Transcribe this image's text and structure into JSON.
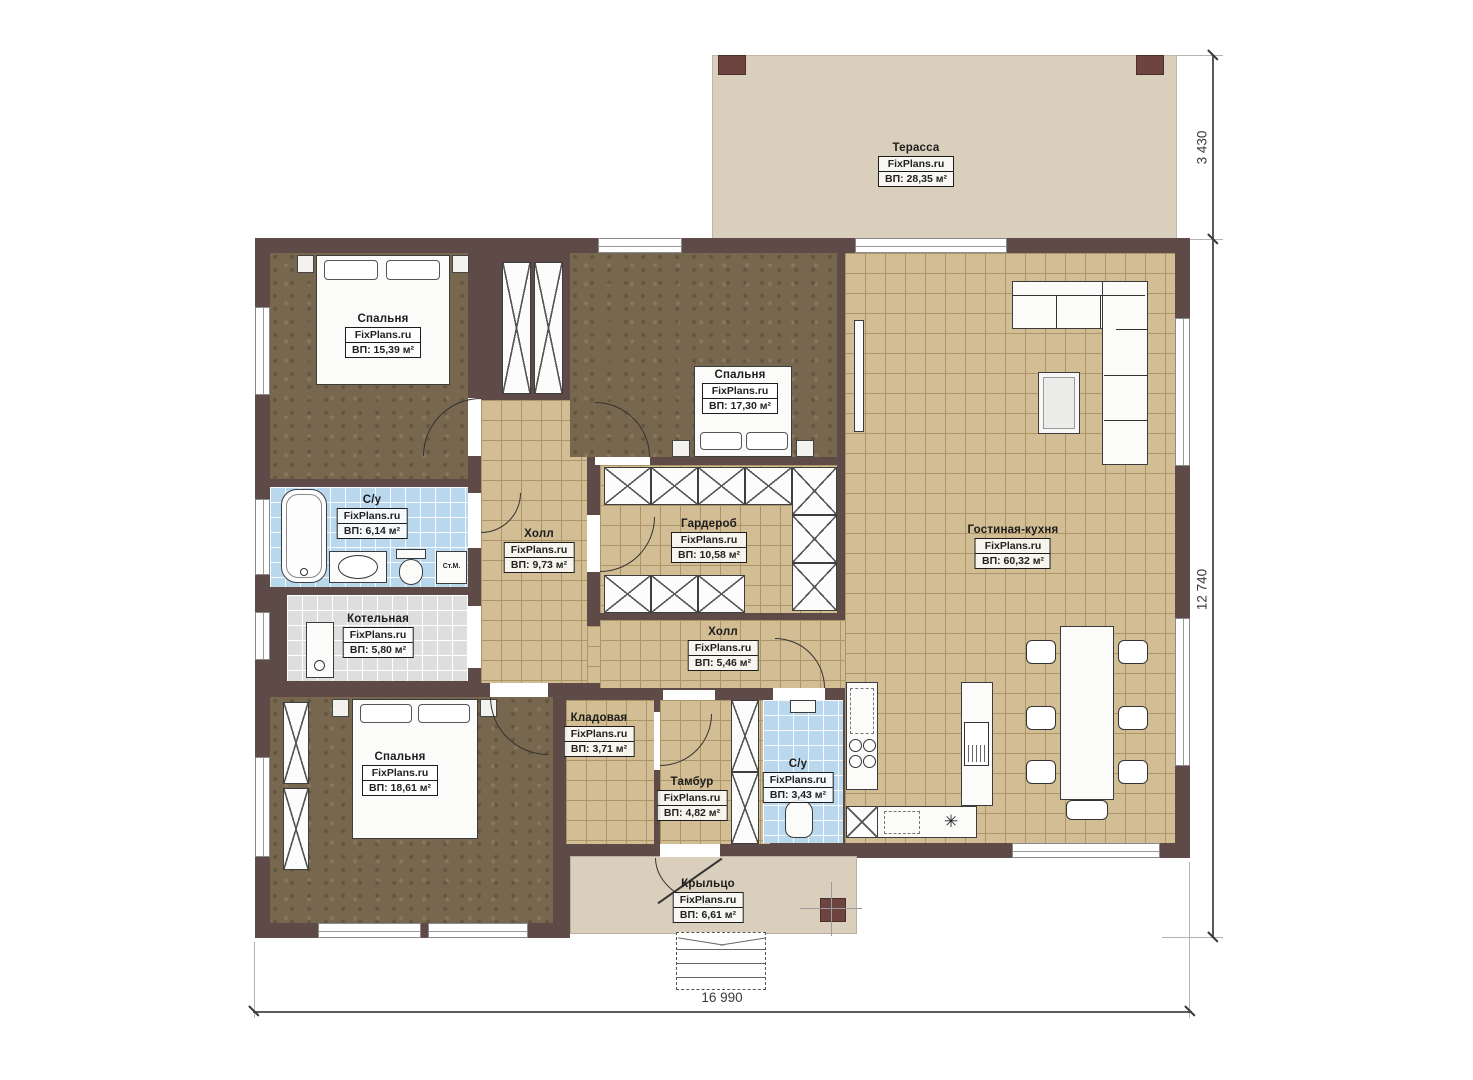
{
  "watermark": "FixPlans.ru",
  "rooms": {
    "terrace": {
      "name": "Терасса",
      "area": "ВП: 28,35 м²"
    },
    "bedroom1": {
      "name": "Спальня",
      "area": "ВП: 15,39 м²"
    },
    "bedroom2": {
      "name": "Спальня",
      "area": "ВП: 17,30 м²"
    },
    "bathroom1": {
      "name": "С/у",
      "area": "ВП: 6,14 м²"
    },
    "hall1": {
      "name": "Холл",
      "area": "ВП: 9,73 м²"
    },
    "wardrobe": {
      "name": "Гардероб",
      "area": "ВП: 10,58 м²"
    },
    "living_kitchen": {
      "name": "Гостиная-кухня",
      "area": "ВП: 60,32 м²"
    },
    "boiler": {
      "name": "Котельная",
      "area": "ВП: 5,80 м²"
    },
    "hall2": {
      "name": "Холл",
      "area": "ВП: 5,46 м²"
    },
    "pantry": {
      "name": "Кладовая",
      "area": "ВП: 3,71 м²"
    },
    "bedroom3": {
      "name": "Спальня",
      "area": "ВП: 18,61 м²"
    },
    "vestibule": {
      "name": "Тамбур",
      "area": "ВП: 4,82 м²"
    },
    "bathroom2": {
      "name": "С/у",
      "area": "ВП: 3,43 м²"
    },
    "porch": {
      "name": "Крыльцо",
      "area": "ВП: 6,61 м²"
    }
  },
  "annotations": {
    "washing_machine": "Ст.М.",
    "sink_symbol": "✳"
  },
  "dimensions": {
    "terrace_depth": "3 430",
    "house_depth": "12 740",
    "house_width": "16 990"
  },
  "colors": {
    "wall": "#5e4b48",
    "tile": "#d2bd94",
    "tile_line": "#ab9668",
    "carpet": "#77674f",
    "blue_tile": "#b9d8ee",
    "gray_tile": "#dedede",
    "terrace": "#d9cfbc",
    "post": "#6d443f",
    "ink": "#1c1c1c"
  }
}
